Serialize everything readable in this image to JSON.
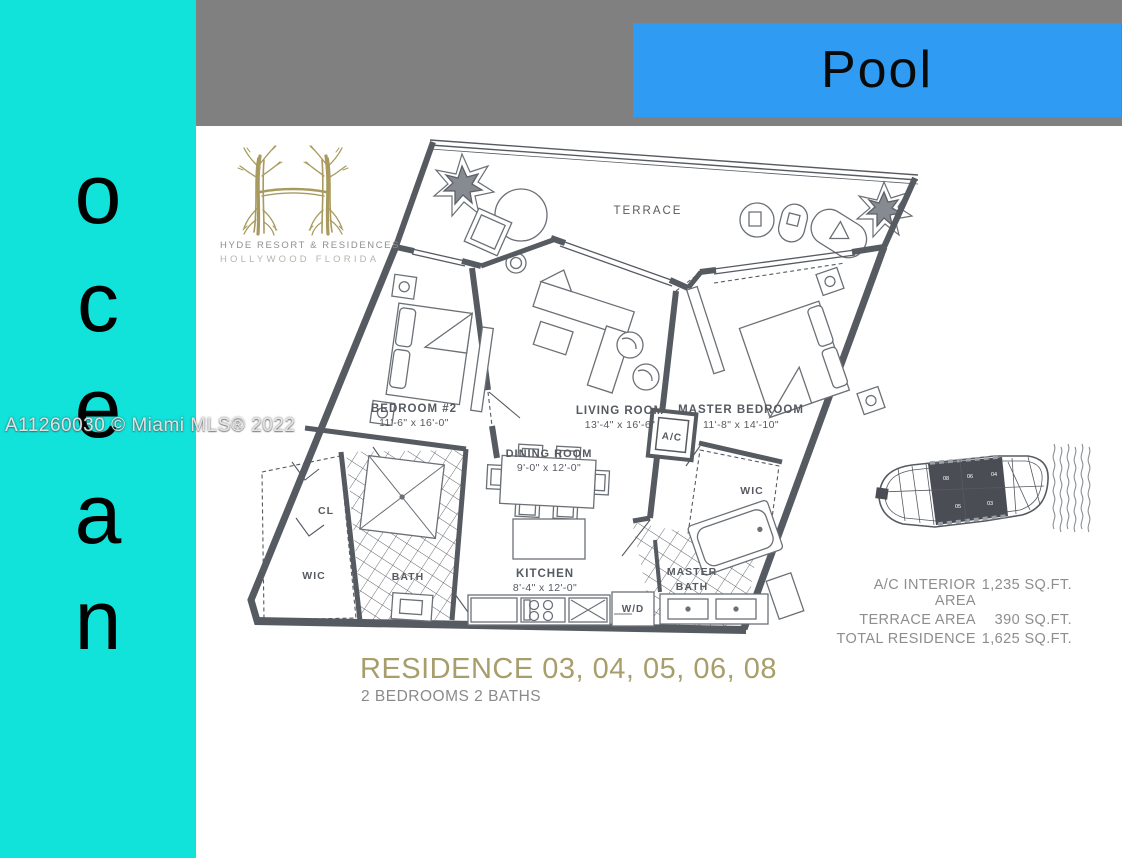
{
  "sidebar": {
    "word": "ocean",
    "letters": [
      "o",
      "c",
      "e",
      "a",
      "n"
    ],
    "bg_color": "#11e2da",
    "text_color": "#000000"
  },
  "header": {
    "bar_color": "#808080",
    "pool_label": "Pool",
    "pool_bg_color": "#2f9bf2"
  },
  "watermark": {
    "text": "A11260030 © Miami MLS® 2022"
  },
  "logo": {
    "monogram": "H",
    "brand": "HYDE RESORT & RESIDENCES",
    "location": "HOLLYWOOD FLORIDA",
    "color": "#a89a5e"
  },
  "floor_plan": {
    "wall_color": "#565a61",
    "rooms": {
      "terrace": {
        "name": "TERRACE",
        "dims": ""
      },
      "bedroom2": {
        "name": "BEDROOM #2",
        "dims": "11'-6\" x 16'-0\""
      },
      "living": {
        "name": "LIVING ROOM",
        "dims": "13'-4\" x 16'-6\""
      },
      "master_bedroom": {
        "name": "MASTER BEDROOM",
        "dims": "11'-8\" x 14'-10\""
      },
      "dining": {
        "name": "DINING ROOM",
        "dims": "9'-0\" x 12'-0\""
      },
      "kitchen": {
        "name": "KITCHEN",
        "dims": "8'-4\" x 12'-0\""
      },
      "master_bath_l1": "MASTER",
      "master_bath_l2": "BATH",
      "bath": "BATH",
      "wic_left": "WIC",
      "wic_master": "WIC",
      "cl": "CL",
      "ac": "A/C",
      "wd": "W/D"
    }
  },
  "key_plan": {
    "highlighted_units": [
      "03",
      "04",
      "05",
      "06",
      "08"
    ],
    "unit_labels_top": [
      "08",
      "06",
      "04"
    ],
    "unit_labels_bottom": [
      "05",
      "03"
    ]
  },
  "areas": {
    "rows": [
      {
        "label": "A/C INTERIOR AREA",
        "value": "1,235 SQ.FT."
      },
      {
        "label": "TERRACE AREA",
        "value": "390 SQ.FT."
      },
      {
        "label": "TOTAL RESIDENCE",
        "value": "1,625 SQ.FT."
      }
    ]
  },
  "title": {
    "residence": "RESIDENCE 03, 04, 05, 06, 08",
    "subtitle": "2 BEDROOMS 2 BATHS",
    "color": "#a89e6c"
  }
}
